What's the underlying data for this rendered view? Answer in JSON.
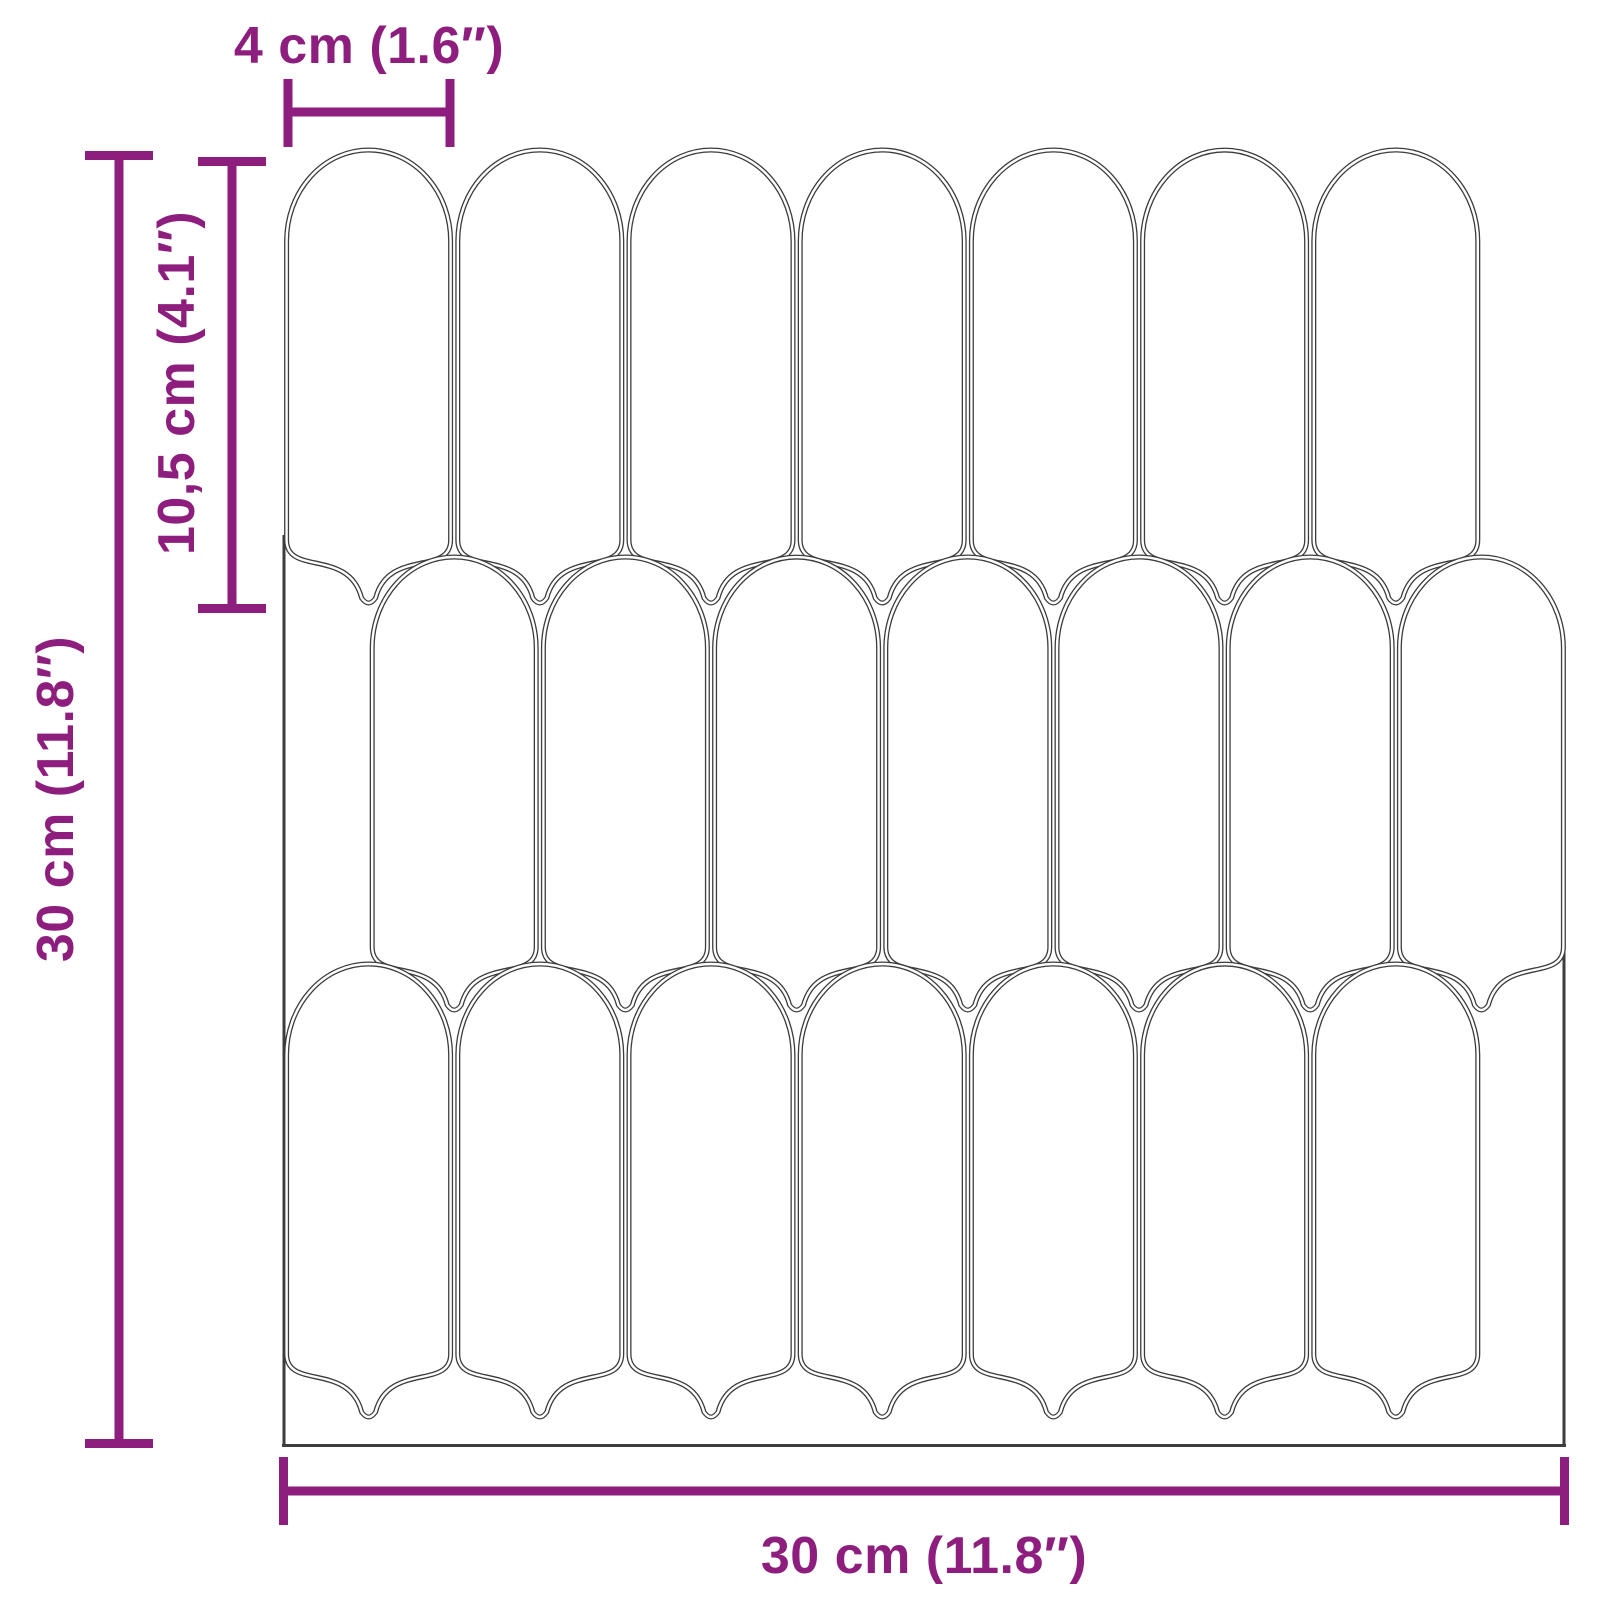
{
  "diagram": {
    "kind": "tile-sheet-dimension-diagram",
    "subject": "self-adhesive mosaic wall tile sheet, picket/arch shaped tiles"
  },
  "annotations": {
    "tile_width_label": "4 cm (1.6″)",
    "tile_height_label": "10,5 cm (4.1″)",
    "sheet_height_label": "30 cm (11.8″)",
    "sheet_width_label": "30 cm (11.8″)"
  },
  "sheet": {
    "rows": 3,
    "tiles_per_row": 7,
    "row_offsets_in_tile_units": [
      0,
      0.5,
      0
    ],
    "tile_shape": "elongated picket: rounded arch top, straight sides, pointed bottom",
    "outline_style": "double line"
  },
  "colors": {
    "dimension_accent": "#8e1e7e",
    "tile_outline": "#3c3c3c",
    "background": "#ffffff"
  }
}
